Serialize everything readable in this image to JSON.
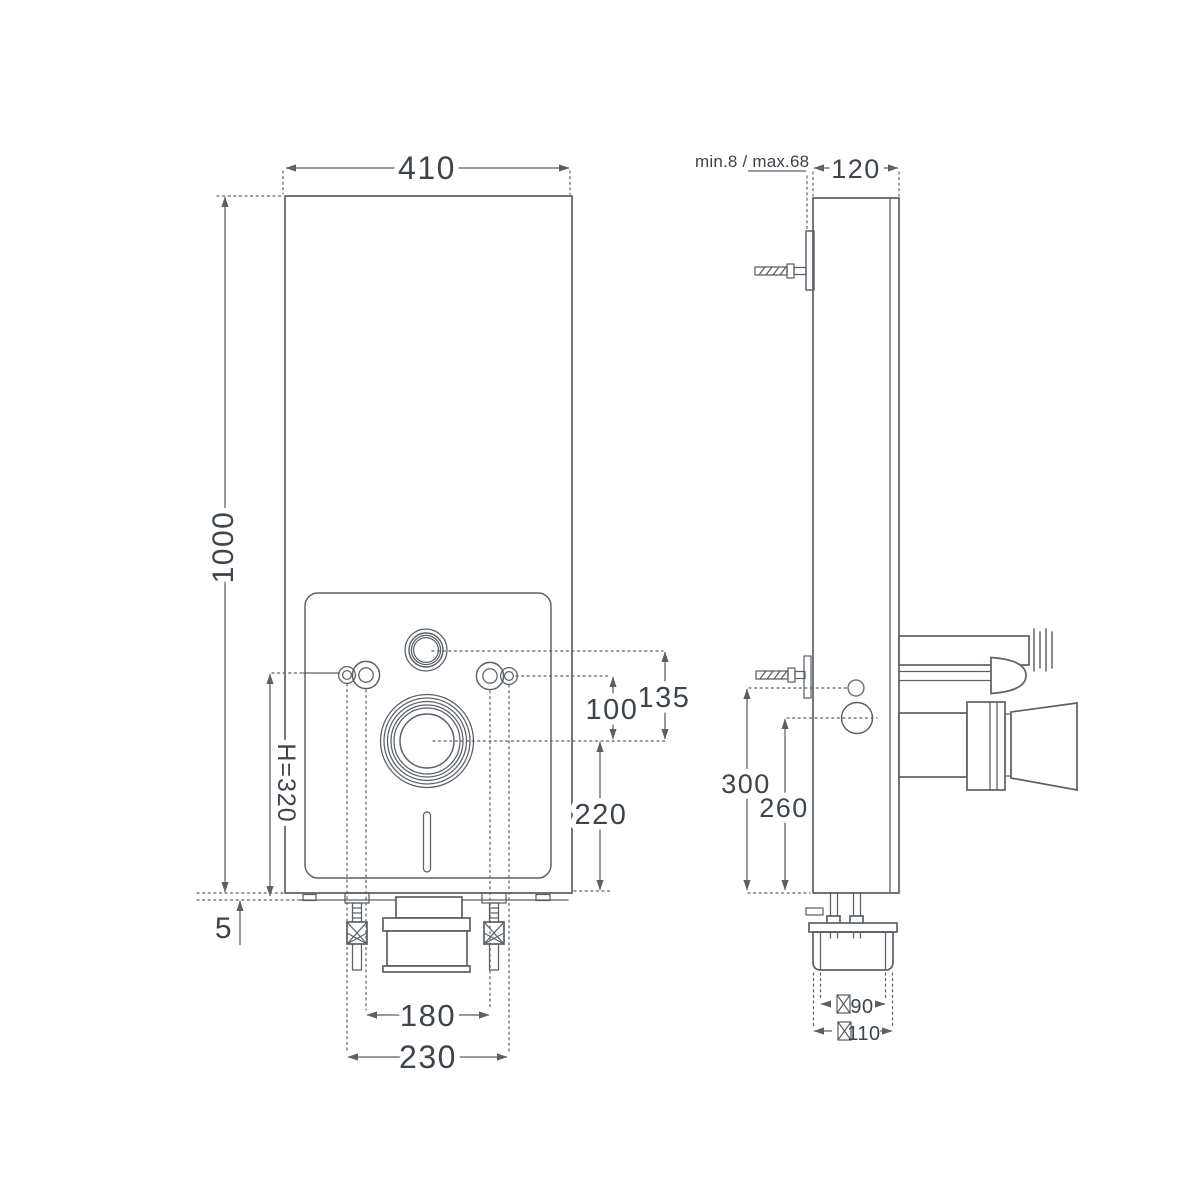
{
  "colors": {
    "line": "#5a6066",
    "text": "#3d444b",
    "background": "#ffffff"
  },
  "front_view": {
    "width_mm": "410",
    "height_mm": "1000",
    "inlet_to_outlet_mm": "135",
    "fixing_to_outlet_mm": "100",
    "outlet_height_mm": "220",
    "fixing_height_mm": "H=320",
    "base_gap_mm": "5",
    "bolt_spacing_mm": "180",
    "fixing_spacing_mm": "230"
  },
  "side_view": {
    "wall_offset_mm": "min.8 / max.68",
    "depth_mm": "120",
    "inlet_height_mm": "300",
    "outlet_centre_height_mm": "260",
    "outlet_diameter_inner_mm": "90",
    "outlet_diameter_outer_mm": "110"
  }
}
